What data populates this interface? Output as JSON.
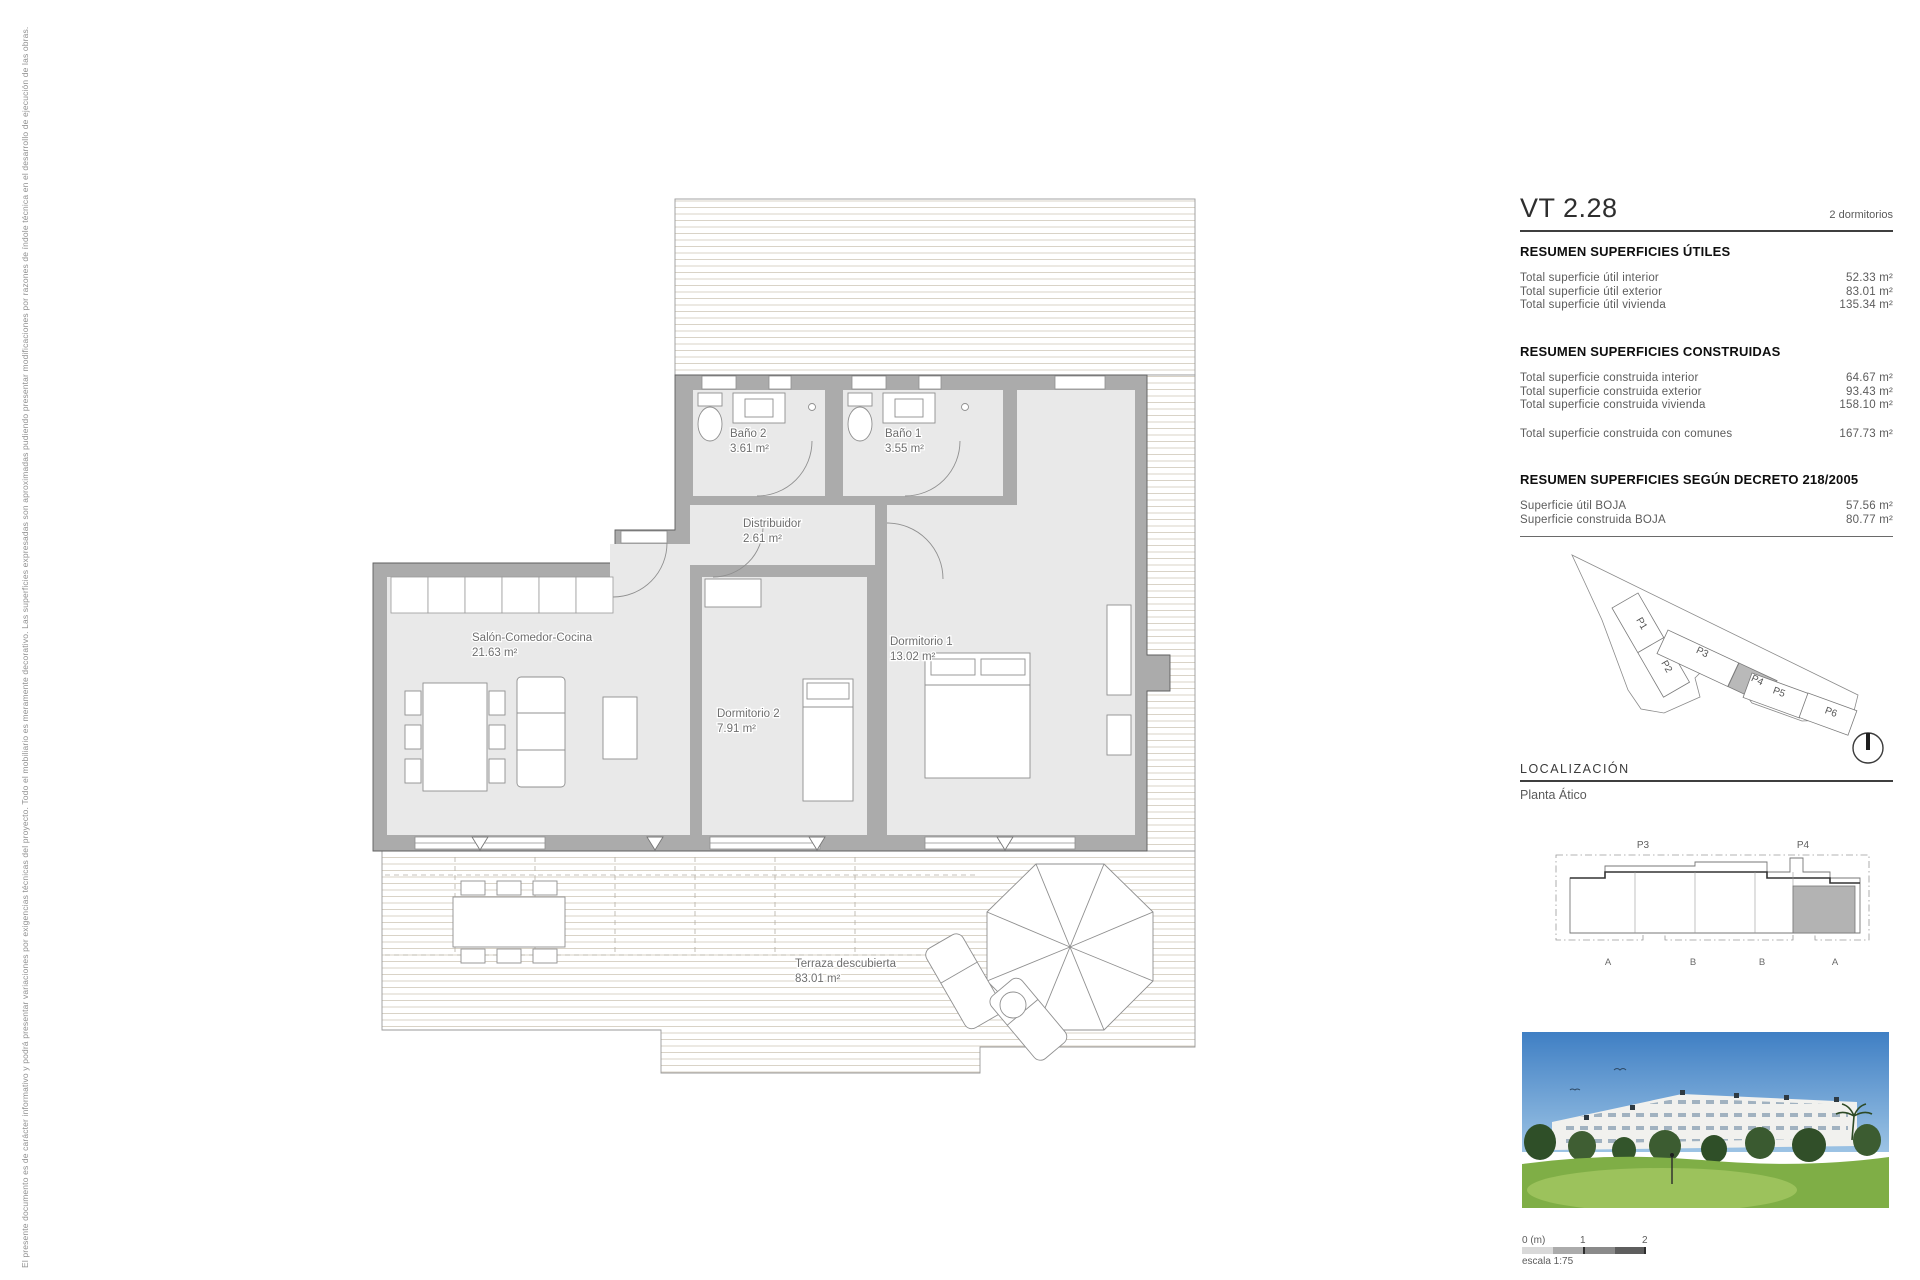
{
  "disclaimer": "El presente documento es de carácter informativo y podrá presentar variaciones por exigencias técnicas del proyecto. Todo el mobiliario es meramente decorativo. Las superficies expresadas son aproximadas pudiendo presentar modificaciones por razones de índole técnica en el desarrollo de ejecución de las obras.",
  "header": {
    "unit_code": "VT 2.28",
    "unit_type": "2 dormitorios"
  },
  "summary_utiles": {
    "title": "RESUMEN SUPERFICIES ÚTILES",
    "rows": [
      {
        "label": "Total superficie útil interior",
        "value": "52.33 m²"
      },
      {
        "label": "Total superficie útil exterior",
        "value": "83.01 m²"
      },
      {
        "label": "Total superficie útil vivienda",
        "value": "135.34 m²"
      }
    ]
  },
  "summary_construidas": {
    "title": "RESUMEN SUPERFICIES CONSTRUIDAS",
    "rows": [
      {
        "label": "Total superficie construida interior",
        "value": "64.67 m²"
      },
      {
        "label": "Total superficie construida exterior",
        "value": "93.43 m²"
      },
      {
        "label": "Total superficie construida vivienda",
        "value": "158.10 m²"
      }
    ],
    "total_row": {
      "label": "Total superficie construida con comunes",
      "value": "167.73 m²"
    }
  },
  "summary_decreto": {
    "title": "RESUMEN SUPERFICIES SEGÚN DECRETO 218/2005",
    "rows": [
      {
        "label": "Superficie útil BOJA",
        "value": "57.56 m²"
      },
      {
        "label": "Superficie construida BOJA",
        "value": "80.77 m²"
      }
    ]
  },
  "site_plan": {
    "labels": [
      "P1",
      "P2",
      "P3",
      "P4",
      "P5",
      "P6"
    ],
    "highlighted": "P4"
  },
  "localizacion": {
    "title": "LOCALIZACIÓN",
    "floor_label": "Planta Ático",
    "block_labels": [
      "P3",
      "P4"
    ],
    "section_labels": [
      "A",
      "B",
      "B",
      "A"
    ]
  },
  "floor_plan": {
    "rooms": {
      "bano2": {
        "name": "Baño 2",
        "area": "3.61 m²"
      },
      "bano1": {
        "name": "Baño 1",
        "area": "3.55 m²"
      },
      "distribuidor": {
        "name": "Distribuidor",
        "area": "2.61 m²"
      },
      "salon": {
        "name": "Salón-Comedor-Cocina",
        "area": "21.63 m²"
      },
      "dormitorio2": {
        "name": "Dormitorio 2",
        "area": "7.91 m²"
      },
      "dormitorio1": {
        "name": "Dormitorio 1",
        "area": "13.02 m²"
      },
      "terraza": {
        "name": "Terraza descubierta",
        "area": "83.01 m²"
      }
    }
  },
  "scale_bar": {
    "zero": "0 (m)",
    "mid": "1",
    "end": "2",
    "caption": "escala 1:75"
  },
  "colors": {
    "wall": "#ababab",
    "room": "#e9e9e9",
    "highlight": "#b9b9b9",
    "deck_line": "#d9d3c7"
  }
}
